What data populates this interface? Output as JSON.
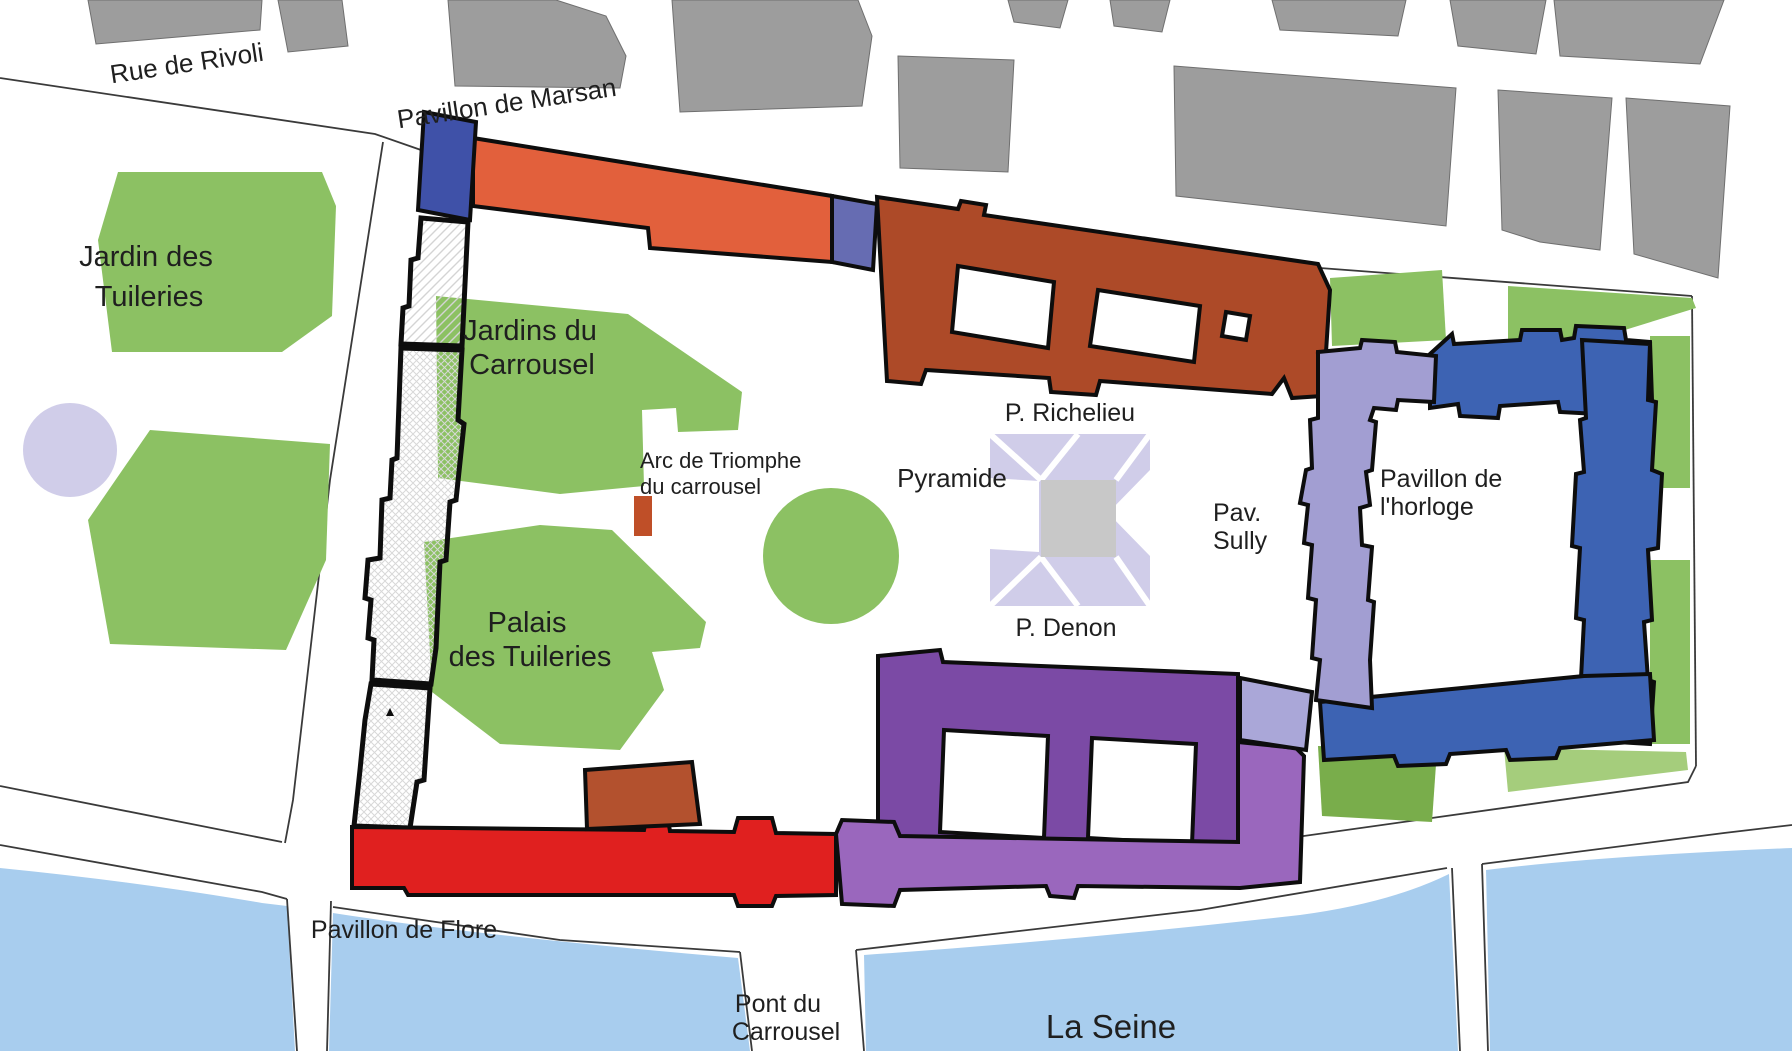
{
  "map": {
    "title": "Plan of the Louvre and Tuileries area",
    "labels": {
      "rue_de_rivoli": "Rue de Rivoli",
      "pavillon_de_marsan": "Pavillon de Marsan",
      "jardin_des_tuileries": [
        "Jardin des",
        "Tuileries"
      ],
      "jardins_du_carrousel": [
        "Jardins du",
        "Carrousel"
      ],
      "arc_de_triomphe": [
        "Arc de Triomphe",
        "du carrousel"
      ],
      "pyramide": "Pyramide",
      "p_richelieu": "P. Richelieu",
      "pav_sully": [
        "Pav.",
        "Sully"
      ],
      "pavillon_horloge": [
        "Pavillon de",
        "l'horloge"
      ],
      "p_denon": "P. Denon",
      "palais_des_tuileries": [
        "Palais",
        "des Tuileries"
      ],
      "pavillon_de_flore": "Pavillon de Flore",
      "pont_du_carrousel": [
        "Pont du",
        "Carrousel"
      ],
      "la_seine": "La Seine"
    },
    "colors": {
      "background": "#ffffff",
      "city_block": "#9d9d9d",
      "garden_green": "#8cc163",
      "garden_green_dark": "#79ad4b",
      "garden_green_light": "#a5cd7c",
      "river_blue": "#a8cdee",
      "pond_lavender": "#d0cde9",
      "pyramid_lavender": "#d0cde9",
      "pyramid_core_gray": "#c8c8c8",
      "marsan_blue": "#3f51a8",
      "rivoli_wing_orange": "#e2603c",
      "rohan_blue": "#666cb2",
      "richelieu_brown": "#ad4a28",
      "denon_purple": "#7b4aa5",
      "waterfront_purple": "#9a67bd",
      "flore_red": "#e0201f",
      "brick": "#b3512e",
      "arc_brick": "#bf4f28",
      "cc_west_lavender": "#a29ed2",
      "cc_connector_lavender": "#aaa7d8",
      "cc_blue": "#3d63b3",
      "hatch_gray": "#d4d4d4",
      "street_line": "#3a3a3a",
      "text": "#1f1f1f"
    }
  }
}
